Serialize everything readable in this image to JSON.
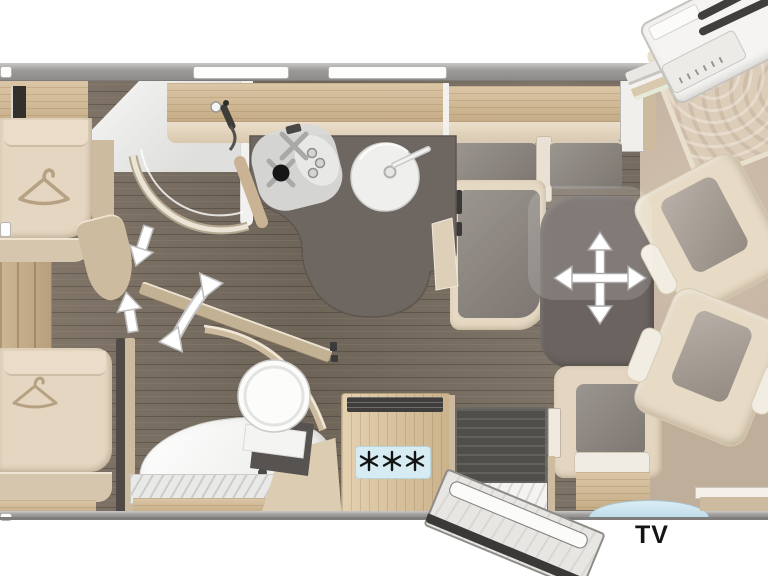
{
  "floorplan": {
    "tv_label": "TV",
    "fridge_panel": {
      "icon": "three-snowflakes",
      "snowflake_count": 3
    },
    "annotations": {
      "table_icon": "four-way-move-arrow",
      "partition_icon": "curved-swivel-arrow",
      "walkway_icons": "direction-arrows",
      "wardrobe_icon": "clothes-hanger"
    },
    "colors": {
      "floor_wood": "#7c7064",
      "furniture_wood": "#d2bc9c",
      "upholstery": "#e6dac5",
      "counter_dark": "#6e6661",
      "cushion_gray": "#8b847e",
      "wall_gray": "#9b9998",
      "tv_accent_blue": "#cfe7f0",
      "cab_floor_tan": "#c9b7a2",
      "fridge_panel_blue": "#d6ecf2"
    }
  }
}
